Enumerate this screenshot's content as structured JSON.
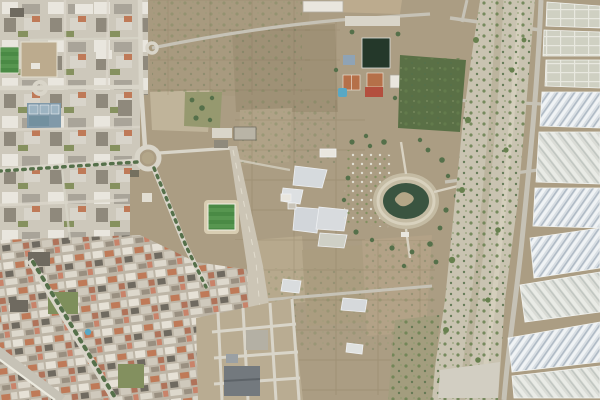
{
  "window": {
    "width": 600,
    "height": 400
  },
  "map": {
    "view_type": "aerial-satellite-imagery",
    "scene": "Aerial view of a Mediterranean coastal town: urban district on the west, dense housing to the southwest, vacant scrubland and farm plots in the centre crossed by a disused airstrip, a municipal sports complex and a park with an oval pond, a dry riverbed running north-south, and plastic greenhouse fields covering the east side",
    "palette": {
      "base_scrub": "#ab9d83",
      "field_tan": "#b5a78c",
      "urban_base": "#cdc8bb",
      "urban_dense_base": "#bdb5a6",
      "road_light": "#d9d5c9",
      "road_mid": "#c6c2b6",
      "runway_gray": "#ccc5b5",
      "pitch_green": "#4a8a45",
      "pitch_green_alt": "#579650",
      "pitch_dark": "#24382a",
      "track_tan": "#d8cdb2",
      "clay_court": "#b57049",
      "pool_blue": "#58a8c5",
      "court_blue": "#8099a9",
      "pond_dark": "#3a5440",
      "park_olive": "#a39d7e",
      "tree_green": "#55704a",
      "shrub_green": "#67804e",
      "gravel": "#c9c3b1",
      "greenhouse_bright": "#d8dee3",
      "greenhouse_stripe_light": "#f0f3f5",
      "greenhouse_stripe_dark": "#aeb9c4",
      "greenhouse_pale": "#dadcd6",
      "greenhouse_old": "#cfd0c2",
      "terracotta": "#bf7a58",
      "building_white": "#e9e6de",
      "building_gray": "#a9a499",
      "warehouse_gray": "#73797e",
      "dirt_field": "#bcab8e"
    },
    "features": [
      {
        "id": "urban-district-west",
        "label": "western urban district"
      },
      {
        "id": "dense-housing-southwest",
        "label": "dense old-town housing"
      },
      {
        "id": "seafront-promenade",
        "label": "seafront promenade"
      },
      {
        "id": "tree-lined-avenue",
        "label": "tree lined avenue"
      },
      {
        "id": "large-roundabout",
        "label": "large roundabout"
      },
      {
        "id": "sports-fields-west",
        "label": "sports fields and courts"
      },
      {
        "id": "sports-complex-north",
        "label": "sports complex with dark pitch, clay courts and pool"
      },
      {
        "id": "football-field-track",
        "label": "football field with running track"
      },
      {
        "id": "airstrip",
        "label": "disused airstrip"
      },
      {
        "id": "greenhouse-cluster-centre",
        "label": "central greenhouse cluster"
      },
      {
        "id": "park-oval-pond",
        "label": "park with oval pond and island"
      },
      {
        "id": "dry-riverbed",
        "label": "dry riverbed (rambla) with shrubs"
      },
      {
        "id": "greenhouses-east",
        "label": "plastic greenhouse fields"
      },
      {
        "id": "development-south",
        "label": "new urban development plots"
      },
      {
        "id": "scrubland-fields",
        "label": "vacant scrubland and farm plots"
      }
    ]
  }
}
